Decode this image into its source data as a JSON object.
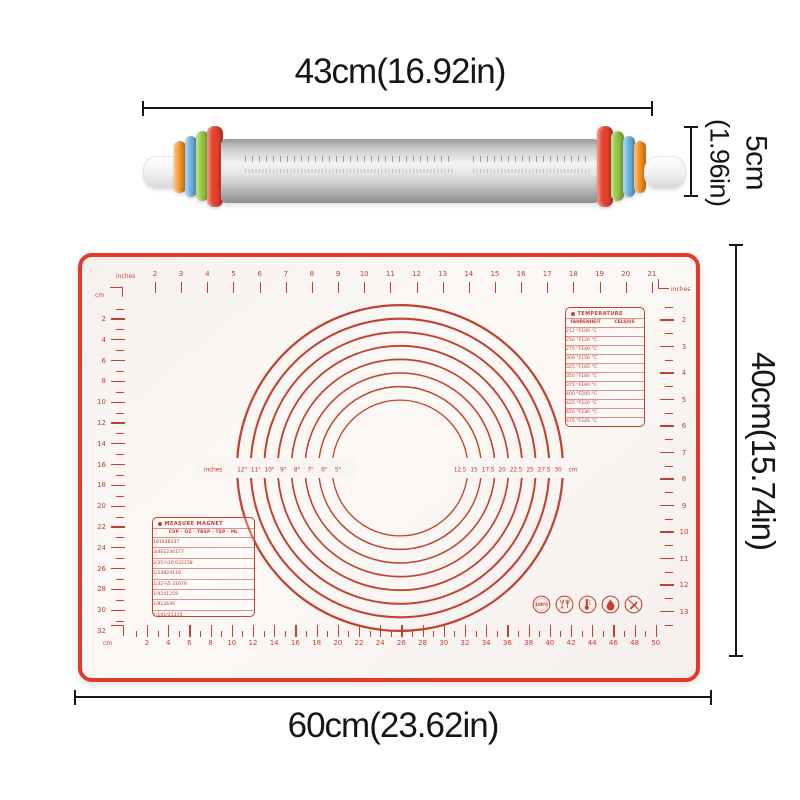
{
  "colors": {
    "mark_red": "#c2402e",
    "border_red": "#e23a2b",
    "dimension_black": "#161616",
    "ring_red": "#e6402c",
    "ring_green": "#94c83d",
    "ring_blue": "#6db4e6",
    "ring_orange": "#f6931f"
  },
  "labels": {
    "pin_length": "43cm(16.92in)",
    "pin_diameter_main": "5cm",
    "pin_diameter_sub": "(1.96in)",
    "mat_width": "60cm(23.62in)",
    "mat_height": "40cm(15.74in)"
  },
  "mat": {
    "top_ruler": {
      "left_unit": "inches",
      "corner_unit": "cm",
      "right_unit": "inches",
      "start": 2,
      "end": 21
    },
    "left_ruler": {
      "top_unit": "cm",
      "start": 2,
      "end": 30,
      "step": 2,
      "corner_number": "32"
    },
    "right_ruler": {
      "start": 2,
      "end": 13
    },
    "bottom_ruler": {
      "left_unit": "cm",
      "start": 2,
      "end": 50,
      "step": 2
    },
    "circles": {
      "left_unit": "inches",
      "inch_labels": [
        "12\"",
        "11\"",
        "10\"",
        "9\"",
        "8\"",
        "7\"",
        "6\"",
        "5\""
      ],
      "cm_values": [
        "12.5",
        "15",
        "17.5",
        "20",
        "22.5",
        "25",
        "27.5",
        "30"
      ],
      "right_unit": "cm"
    },
    "temperature": {
      "title": "TEMPERATURE",
      "headers": [
        "FAHRENHEIT",
        "CELSIUS"
      ],
      "rows": [
        [
          "212 °F",
          "100 °C"
        ],
        [
          "250 °F",
          "120 °C"
        ],
        [
          "275 °F",
          "140 °C"
        ],
        [
          "300 °F",
          "150 °C"
        ],
        [
          "325 °F",
          "165 °C"
        ],
        [
          "350 °F",
          "180 °C"
        ],
        [
          "375 °F",
          "190 °C"
        ],
        [
          "400 °F",
          "205 °C"
        ],
        [
          "425 °F",
          "220 °C"
        ],
        [
          "450 °F",
          "230 °C"
        ],
        [
          "475 °F",
          "245 °C"
        ],
        [
          "500 °F",
          "260 °C"
        ]
      ]
    },
    "measure": {
      "title": "MEASURE MAGNET",
      "headers": [
        "CUP",
        "OZ",
        "TBSP",
        "TSP",
        "ML"
      ],
      "rows": [
        [
          "1",
          "8",
          "16",
          "48",
          "237"
        ],
        [
          "3/4",
          "6",
          "12",
          "36",
          "177"
        ],
        [
          "2/3",
          "5⅓",
          "10.6",
          "32",
          "158"
        ],
        [
          "1/2",
          "4",
          "8",
          "24",
          "118"
        ],
        [
          "1/3",
          "2⅔",
          "5.3",
          "16",
          "79"
        ],
        [
          "1/4",
          "2",
          "4",
          "12",
          "59"
        ],
        [
          "1/8",
          "1",
          "2",
          "6",
          "30"
        ],
        [
          "1/16",
          "1/2",
          "1",
          "3",
          "15"
        ]
      ]
    },
    "badges": [
      {
        "name": "100-percent-badge",
        "text": "100%"
      },
      {
        "name": "food-safe-glass-fork-icon"
      },
      {
        "name": "thermometer-icon"
      },
      {
        "name": "flame-icon"
      },
      {
        "name": "no-knife-icon"
      }
    ]
  }
}
